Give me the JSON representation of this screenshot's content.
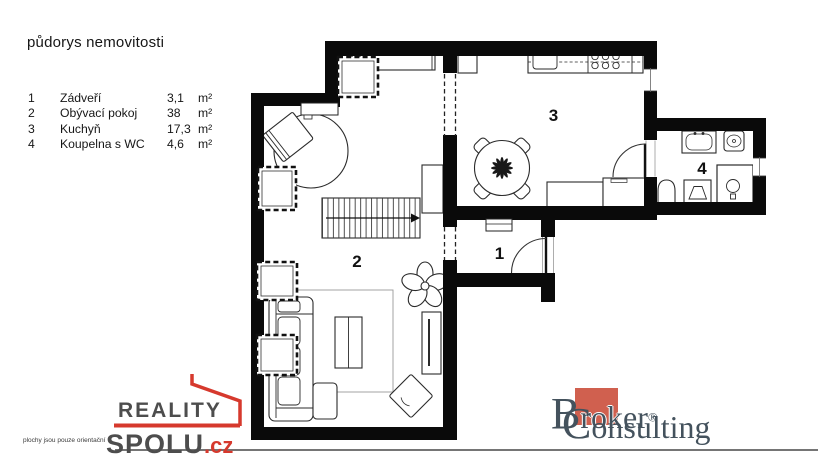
{
  "legend": {
    "title": "půdorys nemovitosti",
    "rooms": [
      {
        "num": "1",
        "name": "Zádveří",
        "area": "3,1",
        "unit": "m²"
      },
      {
        "num": "2",
        "name": "Obývací pokoj",
        "area": "38",
        "unit": "m²"
      },
      {
        "num": "3",
        "name": "Kuchyň",
        "area": "17,3",
        "unit": "m²"
      },
      {
        "num": "4",
        "name": "Koupelna s WC",
        "area": "4,6",
        "unit": "m²"
      }
    ]
  },
  "plan": {
    "room_labels": {
      "r1": "1",
      "r2": "2",
      "r3": "3",
      "r4": "4"
    }
  },
  "footer": {
    "disclaimer": "plochy jsou pouze orientační",
    "reality": {
      "line1": "REALITY",
      "line2": "SPOLU",
      "tld": ".cz"
    },
    "broker": {
      "b": "B",
      "rok": "rok",
      "er": "er",
      "reg": "®",
      "c": "C",
      "onsulting": "onsulting"
    }
  },
  "colors": {
    "wall_black": "#0a0a0a",
    "accent_red": "#d6392d",
    "broker_square": "#d0604f",
    "broker_text": "#44525d",
    "logo_gray": "#4d4d4d"
  }
}
